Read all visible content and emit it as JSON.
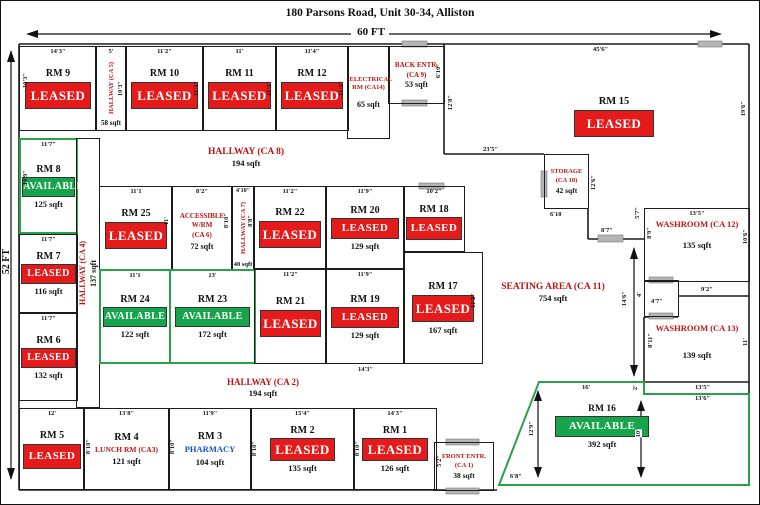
{
  "header": {
    "title": "180 Parsons Road, Unit 30-34, Alliston",
    "width_dim": "60 FT",
    "height_dim": "52 FT"
  },
  "legend": {
    "leased_color": "#e51a1a",
    "available_color": "#18a44c",
    "area_label_color": "#c11212",
    "pharmacy_color": "#1550cc"
  },
  "rooms": {
    "rm9": {
      "name": "RM 9",
      "status": "LEASED",
      "dim_top": "14'3\"",
      "dim_left": "10'3\""
    },
    "hallway_ca5": {
      "name": "HALLWAY (CA 5)",
      "sqft": "58 sqft",
      "dim_top": "5'",
      "dim_right": "10'3\""
    },
    "rm10": {
      "name": "RM 10",
      "status": "LEASED",
      "dim_top": "11'2\"",
      "dim_right": "11'3\""
    },
    "rm11": {
      "name": "RM 11",
      "status": "LEASED",
      "dim_top": "11'",
      "dim_right": "11'3\""
    },
    "rm12": {
      "name": "RM 12",
      "status": "LEASED",
      "dim_top": "11'4\"",
      "dim_right": "11'3\""
    },
    "electrical": {
      "name": "ELECTRICAL RM (CA14)",
      "sqft": "65 sqft"
    },
    "back_entr": {
      "name": "BACK ENTR.",
      "ca": "(CA 9)",
      "sqft": "53 sqft",
      "dim_right": "6'10\"",
      "dim_below": "12'8\""
    },
    "rm15": {
      "name": "RM 15",
      "status": "LEASED",
      "dim_top": "45'6\"",
      "dim_right": "19'6\"",
      "dim_bottom": "23'5\""
    },
    "storage": {
      "name": "STORAGE",
      "ca": "(CA 10)",
      "sqft": "42 sqft",
      "dim_bottom": "6'10",
      "dim_right": "12'6\""
    },
    "hallway_ca8": {
      "name": "HALLWAY (CA 8)",
      "sqft": "194 sqft"
    },
    "rm8": {
      "name": "RM 8",
      "status": "AVAILABLE",
      "sqft": "125 sqft",
      "dim_top": "11'7\"",
      "dim_left": "10'9\""
    },
    "rm7": {
      "name": "RM 7",
      "status": "LEASED",
      "sqft": "116 sqft",
      "dim_top": "11'7\""
    },
    "rm6": {
      "name": "RM 6",
      "status": "LEASED",
      "sqft": "132 sqft",
      "dim_top": "11'7\""
    },
    "hallway_ca4": {
      "name": "HALLWAY (CA 4)",
      "sqft": "137 sqft"
    },
    "rm25": {
      "name": "RM 25",
      "status": "LEASED",
      "dim_top": "11'1",
      "dim_right": "11'"
    },
    "accessible_wr": {
      "name": "ACCESSIBLE W/RM",
      "ca": "(CA 6)",
      "sqft": "72 sqft",
      "dim_top": "8'2\"",
      "dim_right": "8'10\""
    },
    "hallway_ca7": {
      "name": "HALLWAY (CA 7)",
      "sqft": "40 sqft",
      "dim_top": "4'10\"",
      "dim_right": "8'8\""
    },
    "rm22": {
      "name": "RM 22",
      "status": "LEASED",
      "dim_top": "11'2\""
    },
    "rm20": {
      "name": "RM 20",
      "status": "LEASED",
      "sqft": "129 sqft",
      "dim_top": "11'9\""
    },
    "rm18": {
      "name": "RM 18",
      "status": "LEASED",
      "dim_top": "10'2\""
    },
    "rm24": {
      "name": "RM 24",
      "status": "AVAILABLE",
      "sqft": "122 sqft",
      "dim_top": "11'1"
    },
    "rm23": {
      "name": "RM 23",
      "status": "AVAILABLE",
      "sqft": "172 sqft",
      "dim_top": "13'"
    },
    "rm21": {
      "name": "RM 21",
      "status": "LEASED",
      "dim_top": "11'2\""
    },
    "rm19": {
      "name": "RM 19",
      "status": "LEASED",
      "sqft": "129 sqft",
      "dim_top": "11'9\""
    },
    "rm17": {
      "name": "RM 17",
      "status": "LEASED",
      "sqft": "167 sqft",
      "dim_right": "11'2\""
    },
    "hallway_ca2": {
      "name": "HALLWAY (CA 2)",
      "sqft": "194 sqft"
    },
    "seating": {
      "name": "SEATING AREA (CA 11)",
      "sqft": "754 sqft"
    },
    "washroom_ca12": {
      "name": "WASHROOM (CA 12)",
      "sqft": "135 sqft",
      "dim_top": "13'5\"",
      "dim_right": "10'6\"",
      "dim_left_upper": "5'7\"",
      "dim_left_lower": "8'9\"",
      "dim_bottom": "9'2\""
    },
    "vestibule": {
      "dim_width": "4'7\"",
      "dim_height": "4'"
    },
    "washroom_ca13": {
      "name": "WASHROOM (CA 13)",
      "sqft": "139 sqft",
      "dim_left": "8'11\"",
      "dim_right": "11'",
      "dim_bottom": "13'5\"",
      "dim_below": "13'6\""
    },
    "rm16": {
      "name": "RM 16",
      "status": "AVAILABLE",
      "sqft": "392 sqft",
      "dim_top": "16'",
      "dim_left": "12'9\"",
      "dim_right": "10'",
      "dim_bottom_left": "6'8\"",
      "dim_notch": "2'",
      "dim_vertical": "14'6\""
    },
    "rm5": {
      "name": "RM 5",
      "status": "LEASED",
      "dim_top": "12'"
    },
    "rm4": {
      "name": "RM 4",
      "subtitle": "LUNCH RM (CA3)",
      "sqft": "121 sqft",
      "dim_top": "13'8\"",
      "dim_left": "8'10\""
    },
    "rm3": {
      "name": "RM 3",
      "subtitle": "PHARMACY",
      "sqft": "104 sqft",
      "dim_top": "11'9\"",
      "dim_left": "8'10\""
    },
    "rm2": {
      "name": "RM 2",
      "status": "LEASED",
      "sqft": "135 sqft",
      "dim_top": "15'4\"",
      "dim_left": "8'10\""
    },
    "rm1": {
      "name": "RM 1",
      "status": "LEASED",
      "sqft": "126 sqft",
      "dim_top": "14'3\"",
      "dim_left": "8'10\""
    },
    "front_entr": {
      "name": "FRONT ENTR.",
      "ca": "(CA 1)",
      "sqft": "38 sqft",
      "dim_left": "5'2\""
    },
    "connector": {
      "dim": "8'7\""
    }
  },
  "extra_dims": {
    "mid_bottom": "14'3\""
  }
}
